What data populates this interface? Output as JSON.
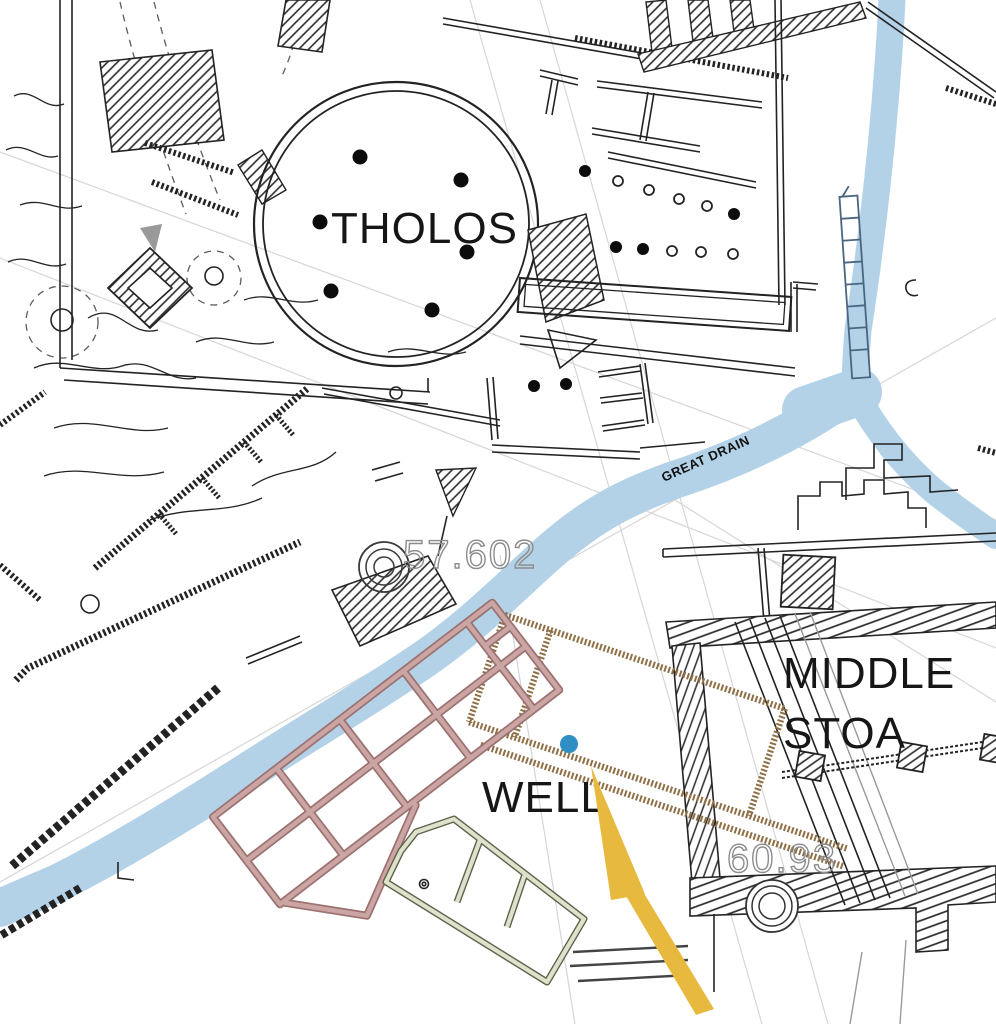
{
  "map": {
    "labels": {
      "tholos": "THOLOS",
      "great_drain": "GREAT DRAIN",
      "middle_stoa_line1": "MIDDLE",
      "middle_stoa_line2": "STOA",
      "well": "WELL"
    },
    "elevations": {
      "drain_point": "57.602",
      "stoa_point": "60.93"
    },
    "colors": {
      "drain": "#b3d2e8",
      "drain_channel": "#4a6580",
      "pink_edge": "#9b7170",
      "pink_fill": "#cba5a3",
      "brown": "#8f6f45",
      "olive_edge": "#5f6149",
      "olive_fill": "#dee2cc",
      "arrow_yellow": "#e7ba3f",
      "well_dot": "#2f8fc4",
      "ink": "#232323",
      "elevation_text": "#8c8c8c",
      "reference_line": "#d6d6d6"
    }
  }
}
